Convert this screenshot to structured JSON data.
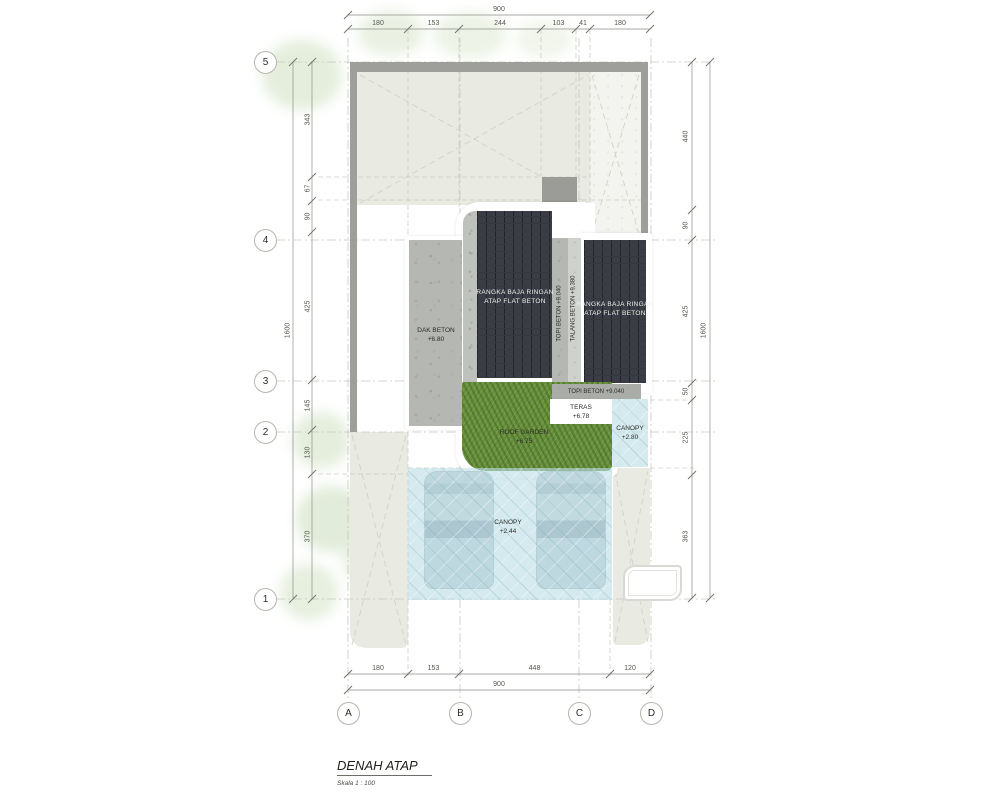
{
  "title": {
    "main": "DENAH ATAP",
    "scale": "Skala 1 : 100"
  },
  "grid": {
    "rows": [
      "5",
      "4",
      "3",
      "2",
      "1"
    ],
    "cols": [
      "A",
      "B",
      "C",
      "D"
    ]
  },
  "dims": {
    "top": {
      "overall": "900",
      "segments": [
        "180",
        "153",
        "244",
        "103",
        "41",
        "180"
      ]
    },
    "bottom": {
      "overall": "900",
      "segments": [
        "180",
        "153",
        "448",
        "120"
      ]
    },
    "left": {
      "overall": "1600",
      "segments": [
        "343",
        "67",
        "90",
        "425",
        "145",
        "130",
        "370"
      ]
    },
    "right": {
      "overall": "1600",
      "segments": [
        "440",
        "90",
        "425",
        "50",
        "225",
        "363"
      ]
    }
  },
  "areas": {
    "roof1": {
      "l1": "RANGKA BAJA RINGAN",
      "l2": "ATAP FLAT BETON"
    },
    "roof2": {
      "l1": "RANGKA BAJA RINGAN",
      "l2": "ATAP FLAT BETON"
    },
    "dak": {
      "l1": "DAK BETON",
      "l2": "+6.80"
    },
    "topi_v": "TOPI BETON +9.040",
    "talang_v": "TALANG BETON +9.380",
    "topi_h": "TOPI BETON +9.040",
    "teras": {
      "l1": "TERAS",
      "l2": "+6.78"
    },
    "garden": {
      "l1": "ROOF GARDEN",
      "l2": "+6.75"
    },
    "canopy_hi": {
      "l1": "CANOPY",
      "l2": "+2.80"
    },
    "canopy_lo": {
      "l1": "CANOPY",
      "l2": "+2.44"
    }
  },
  "colors": {
    "roof_tile": "#3a3d45",
    "concrete": "#b5b7b2",
    "grass": "#678f3d",
    "canopy_glass": "#badde5",
    "wall": "#9e9e9a",
    "yard": "#e9ebe2"
  }
}
